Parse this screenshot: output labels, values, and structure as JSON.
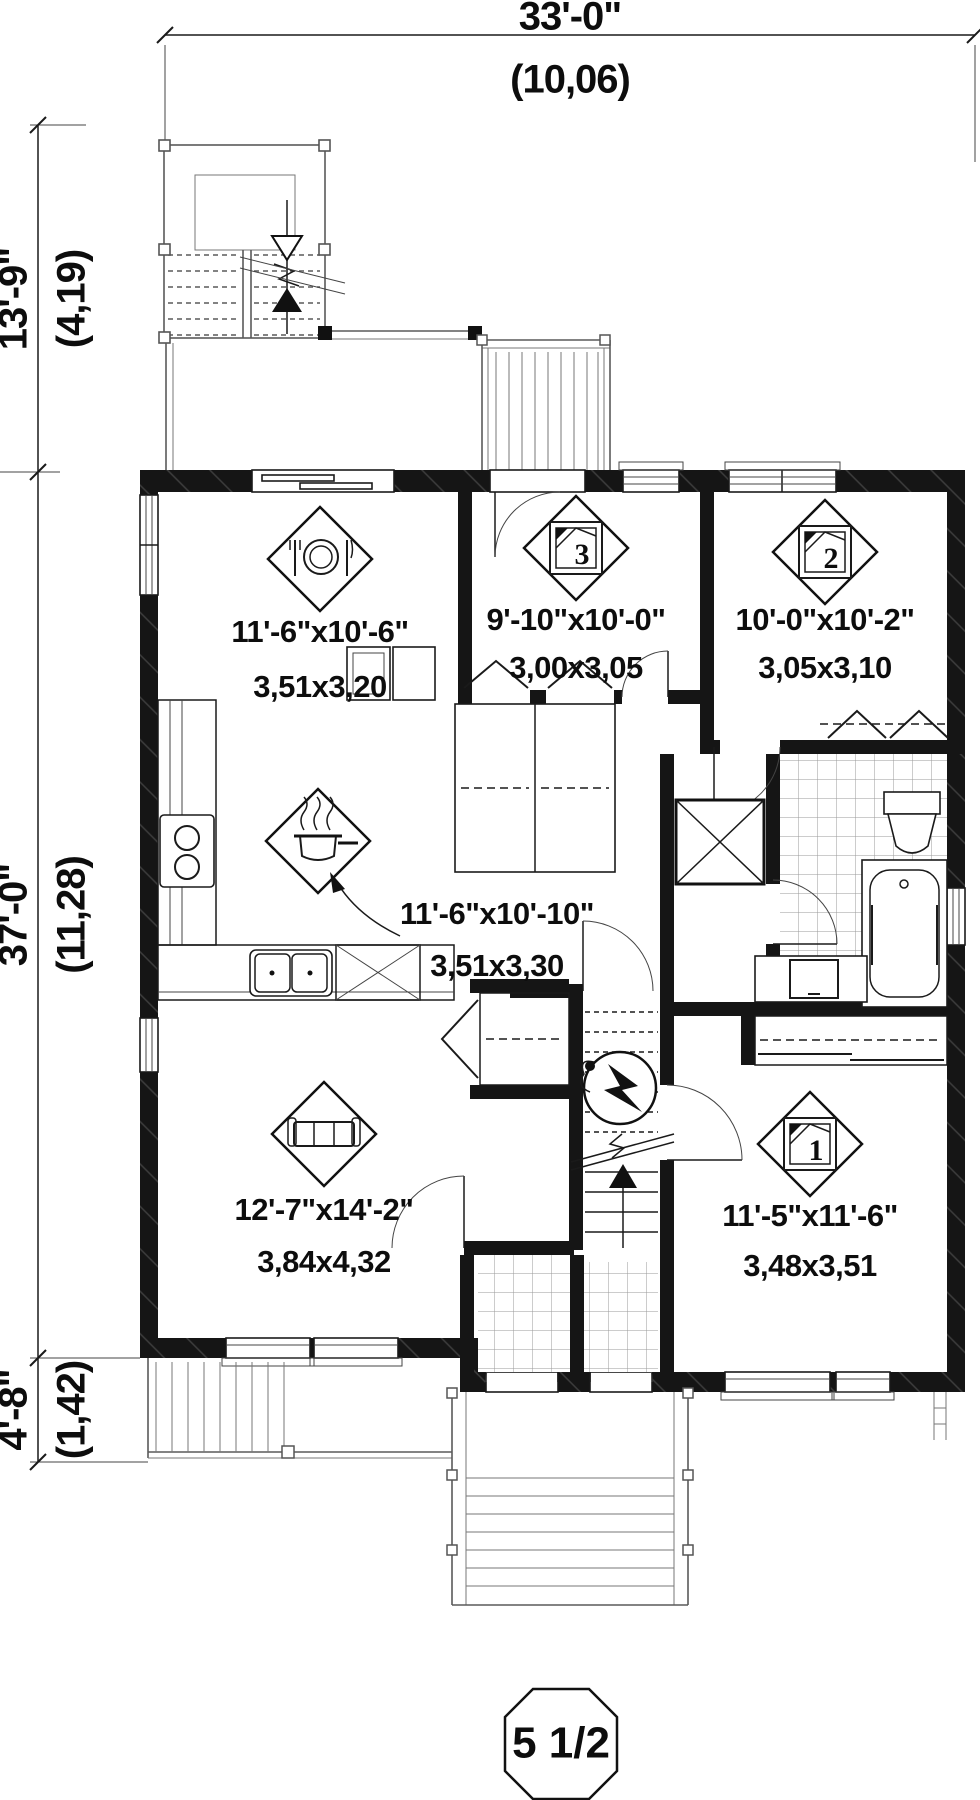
{
  "plan": {
    "scale_badge": "5 1/2",
    "dimensions": {
      "top": {
        "imperial": "33'-0\"",
        "metric": "(10,06)"
      },
      "left_upper": {
        "imperial": "13'-9\"",
        "metric": "(4,19)"
      },
      "left_main": {
        "imperial": "37'-0\"",
        "metric": "(11,28)"
      },
      "left_lower": {
        "imperial": "4'-8\"",
        "metric": "(1,42)"
      }
    },
    "rooms": {
      "dining": {
        "imperial": "11'-6\"x10'-6\"",
        "metric": "3,51x3,20",
        "icon": "dining-place-setting-icon"
      },
      "bedroom3": {
        "imperial": "9'-10\"x10'-0\"",
        "metric": "3,00x3,05",
        "icon": "bed-icon",
        "icon_number": "3"
      },
      "bedroom2": {
        "imperial": "10'-0\"x10'-2\"",
        "metric": "3,05x3,10",
        "icon": "bed-icon",
        "icon_number": "2"
      },
      "kitchen": {
        "imperial": "11'-6\"x10'-10\"",
        "metric": "3,51x3,30",
        "icon": "cooking-pot-icon"
      },
      "living": {
        "imperial": "12'-7\"x14'-2\"",
        "metric": "3,84x4,32",
        "icon": "sofa-icon"
      },
      "bedroom1": {
        "imperial": "11'-5\"x11'-6\"",
        "metric": "3,48x3,51",
        "icon": "bed-icon",
        "icon_number": "1"
      }
    }
  }
}
